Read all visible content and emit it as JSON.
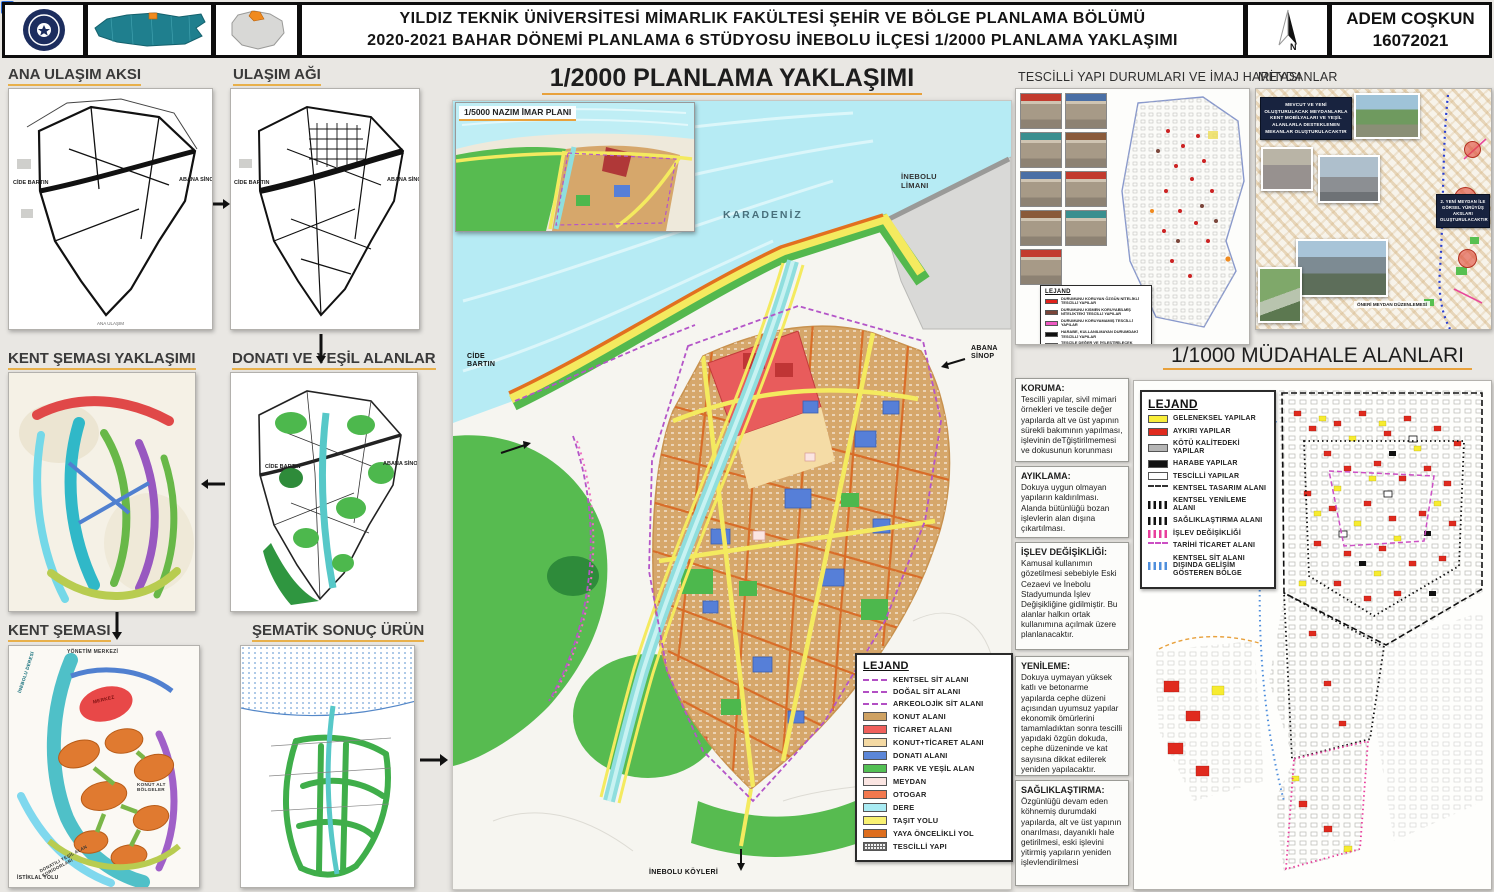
{
  "header": {
    "title_line1": "YILDIZ TEKNİK ÜNİVERSİTESİ MİMARLIK FAKÜLTESİ ŞEHİR VE BÖLGE PLANLAMA BÖLÜMÜ",
    "title_line2": "2020-2021 BAHAR DÖNEMİ PLANLAMA 6 STÜDYOSU İNEBOLU İLÇESİ 1/2000 PLANLAMA YAKLAŞIMI",
    "author": "ADEM COŞKUN",
    "number": "16072021",
    "north_label": "N"
  },
  "flow": {
    "ana_ulasim_aksi": "ANA ULAŞIM AKSI",
    "ulasim_agi": "ULAŞIM AĞI",
    "kent_semasi_yaklasimi": "KENT ŞEMASI YAKLAŞIMI",
    "donati_ve_yesil_alanlar": "DONATI VE YEŞİL ALANLAR",
    "kent_semasi": "KENT ŞEMASI",
    "sematik_sonuc_urun": "ŞEMATİK SONUÇ ÜRÜN",
    "road_label_west": "CİDE BARTIN",
    "road_label_east": "ABANA SİNOP",
    "kent_semasi_notes": {
      "yonetim_merkezi": "YÖNETİM MERKEZİ",
      "inebolu_deresi": "İNEBOLU DERESİ",
      "merkez": "MERKEZ",
      "konut_alt_bolgeler": "KONUT ALT BÖLGELER",
      "donatili_koridor": "DONATILI YEŞİL ALAN KORİDORLARI",
      "istiklal_yolu": "İSTİKLAL YOLU"
    }
  },
  "main_map": {
    "title": "1/2000 PLANLAMA YAKLAŞIMI",
    "inset_title": "1/5000 NAZIM İMAR PLANI",
    "labels": {
      "sea": "KARADENİZ",
      "port": "İNEBOLU LİMANI",
      "west": "CİDE BARTIN",
      "east": "ABANA SİNOP",
      "south": "İNEBOLU KÖYLERİ"
    },
    "legend": {
      "title": "LEJAND",
      "items": [
        {
          "label": "KENTSEL SİT ALANI",
          "color": "#b24fc4"
        },
        {
          "label": "DOĞAL SİT ALANI",
          "color": "#b24fc4"
        },
        {
          "label": "ARKEOLOJİK SİT ALANI",
          "color": "#b24fc4"
        },
        {
          "label": "KONUT ALANI",
          "color": "#cfa263"
        },
        {
          "label": "TİCARET ALANI",
          "color": "#f0605c"
        },
        {
          "label": "KONUT+TİCARET ALANI",
          "color": "#f4d9a3"
        },
        {
          "label": "DONATI ALANI",
          "color": "#5b86d8"
        },
        {
          "label": "PARK VE YEŞİL ALAN",
          "color": "#53c054"
        },
        {
          "label": "MEYDAN",
          "color": "#fbe5e2"
        },
        {
          "label": "OTOGAR",
          "color": "#f2784e"
        },
        {
          "label": "DERE",
          "color": "#a9ebf3"
        },
        {
          "label": "TAŞIT YOLU",
          "color": "#f8f171"
        },
        {
          "label": "YAYA ÖNCELİKLİ YOL",
          "color": "#dd6d1d"
        },
        {
          "label": "TESCİLLİ YAPI",
          "color": "#666666"
        }
      ]
    }
  },
  "tescilli": {
    "title": "TESCİLLİ YAPI DURUMLARI VE İMAJ HARİTASI",
    "legend": {
      "title": "LEJAND",
      "items": [
        {
          "label": "DURUMUNU KORUYAN ÖZGÜN NİTELİKLİ TESCİLLİ YAPILAR",
          "color": "#e0221c"
        },
        {
          "label": "DURUMUNU KISMEN KORUYABİLMİŞ NİTELİKTEKİ TESCİLLİ YAPILAR",
          "color": "#7a453a"
        },
        {
          "label": "DURUMUNU KORUYAMAMIŞ TESCİLLİ YAPILAR",
          "color": "#ee58c2"
        },
        {
          "label": "HARABE, KULLANILMAYAN DURUMDAKİ TESCİLLİ YAPILAR",
          "color": "#101010"
        },
        {
          "label": "TESCİLE DEĞER VE İYİLEŞTİRİLECEK YAPILAR",
          "color": "#f08a1e"
        }
      ]
    }
  },
  "meydanlar": {
    "title": "MEYDANLAR",
    "note_top": "MEVCUT VE YENİ OLUŞTURULACAK MEYDANLARLA KENT MOBİLYALARI VE YEŞİL ALANLARLA DESTEKLENEN MEKANLAR OLUŞTURULACAKTIR",
    "note_right": "2. YENİ MEYDAN İLE GÖRSEL YÜRÜYÜŞ AKSLARI OLUŞTURULACAKTIR",
    "caption": "ÖNERİ MEYDAN DÜZENLEMESİ"
  },
  "mudahale": {
    "title": "1/1000 MÜDAHALE ALANLARI",
    "legend": {
      "title": "LEJAND",
      "items": [
        {
          "label": "GELENEKSEL YAPILAR",
          "color": "#f9ee3a"
        },
        {
          "label": "AYKIRI YAPILAR",
          "color": "#e02a1e"
        },
        {
          "label": "KÖTÜ KALİTEDEKİ YAPILAR",
          "color": "#b5b5b5"
        },
        {
          "label": "HARABE YAPILAR",
          "color": "#111111"
        },
        {
          "label": "TESCİLLİ YAPILAR",
          "color": "#ffffff"
        },
        {
          "label": "KENTSEL TASARIM ALANI",
          "color": "#333333"
        },
        {
          "label": "KENTSEL YENİLEME ALANI",
          "color": "#111111"
        },
        {
          "label": "SAĞLIKLAŞTIRMA ALANI",
          "color": "#111111"
        },
        {
          "label": "İŞLEV DEĞİŞİKLİĞİ",
          "color": "#e83e9c"
        },
        {
          "label": "TARİHİ TİCARET ALANI",
          "color": "#cc4fc4"
        },
        {
          "label": "KENTSEL SİT ALANI DIŞINDA GELİŞİM GÖSTEREN BÖLGE",
          "color": "#4f8fdd"
        }
      ]
    }
  },
  "interventions": [
    {
      "heading": "KORUMA:",
      "body": "Tescilli yapılar, sivil mimari örnekleri ve tescile değer yapılarda alt ve üst yapının sürekli bakımının yapılması, işlevinin deTğiştirilmemesi ve dokusunun korunması"
    },
    {
      "heading": "AYIKLAMA:",
      "body": "Dokuya uygun olmayan yapıların kaldırılması. Alanda bütünlüğü bozan işlevlerin alan dışına çıkartılması."
    },
    {
      "heading": "İŞLEV DEĞİŞİKLİĞİ:",
      "body": "Kamusal kullanımın gözetilmesi sebebiyle Eski Cezaevi ve İnebolu Stadyumunda İşlev Değişikliğine gidilmiştir. Bu alanlar halkın ortak kullanımına açılmak üzere planlanacaktır."
    },
    {
      "heading": "YENİLEME:",
      "body": "Dokuya uymayan yüksek katlı ve betonarme yapılarda cephe düzeni açısından uyumsuz yapılar ekonomik ömürlerini tamamladıktan sonra tescilli yapıdaki özgün dokuda, cephe düzeninde ve kat sayısına dikkat edilerek yeniden yapılacaktır."
    },
    {
      "heading": "SAĞLIKLAŞTIRMA:",
      "body": "Özgünlüğü devam eden köhnemiş durumdaki yapılarda, alt ve üst yapının onarılması, dayanıklı hale getirilmesi, eski işlevini yitirmiş yapıların yeniden işlevlendirilmesi"
    }
  ]
}
